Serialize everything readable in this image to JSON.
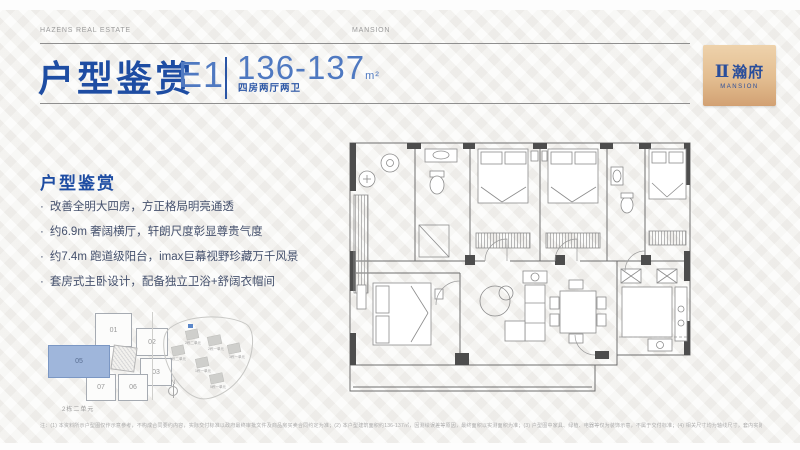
{
  "header": {
    "brand_left": "HAZENS REAL ESTATE",
    "brand_center": "MANSION"
  },
  "logo": {
    "symbol": "Ⅱ",
    "name_cn": "瀚府",
    "name_en": "MANSION"
  },
  "title": {
    "main": "户型鉴赏",
    "unit_code": "E1",
    "area_range": "136-137",
    "area_unit": "m²",
    "layout_desc": "四房两厅两卫"
  },
  "features": {
    "heading": "户型鉴赏",
    "bullet_char": "·",
    "bullets": [
      "改善全明大四房，方正格局明亮通透",
      "约6.9m 奢阔横厅，轩朗尺度彰显尊贵气度",
      "约7.4m 跑道级阳台，imax巨幕视野珍藏万千风景",
      "套房式主卧设计，配备独立卫浴+舒阔衣帽间"
    ]
  },
  "key_plan": {
    "units": [
      "01",
      "02",
      "03",
      "05",
      "06",
      "07"
    ],
    "highlighted_unit": "07",
    "caption": "2栋二单元"
  },
  "site_plan": {
    "north_label": "N",
    "building_labels": [
      "2栋二单元",
      "2栋一单元",
      "3栋一单元",
      "1栋二单元",
      "1栋一单元",
      "5栋一单元",
      "6栋一单元"
    ]
  },
  "disclaimer": "注：(1) 本资料所示户型图仅作示意参考，不构成合同要约内容，实际交付标准以政府最终审批文件及商品房买卖合同约定为准；(2) 本户型建筑面积约136-137㎡，因测绘误差等原因，最终面积以实测面积为准；(3) 户型图中家具、绿植、电器等仅为装饰示意，不属于交付标准；(4) 相关尺寸均为轴线尺寸，套内实际尺寸以现场实际为准；(5) 本公司保留对宣传资料进行修改的权利，敬请留意最新资料。",
  "colors": {
    "accent_blue": "#1e4da3",
    "light_blue": "#4f79c1",
    "logo_tan": "#e3bd90",
    "highlight_unit": "#9fb6db"
  }
}
